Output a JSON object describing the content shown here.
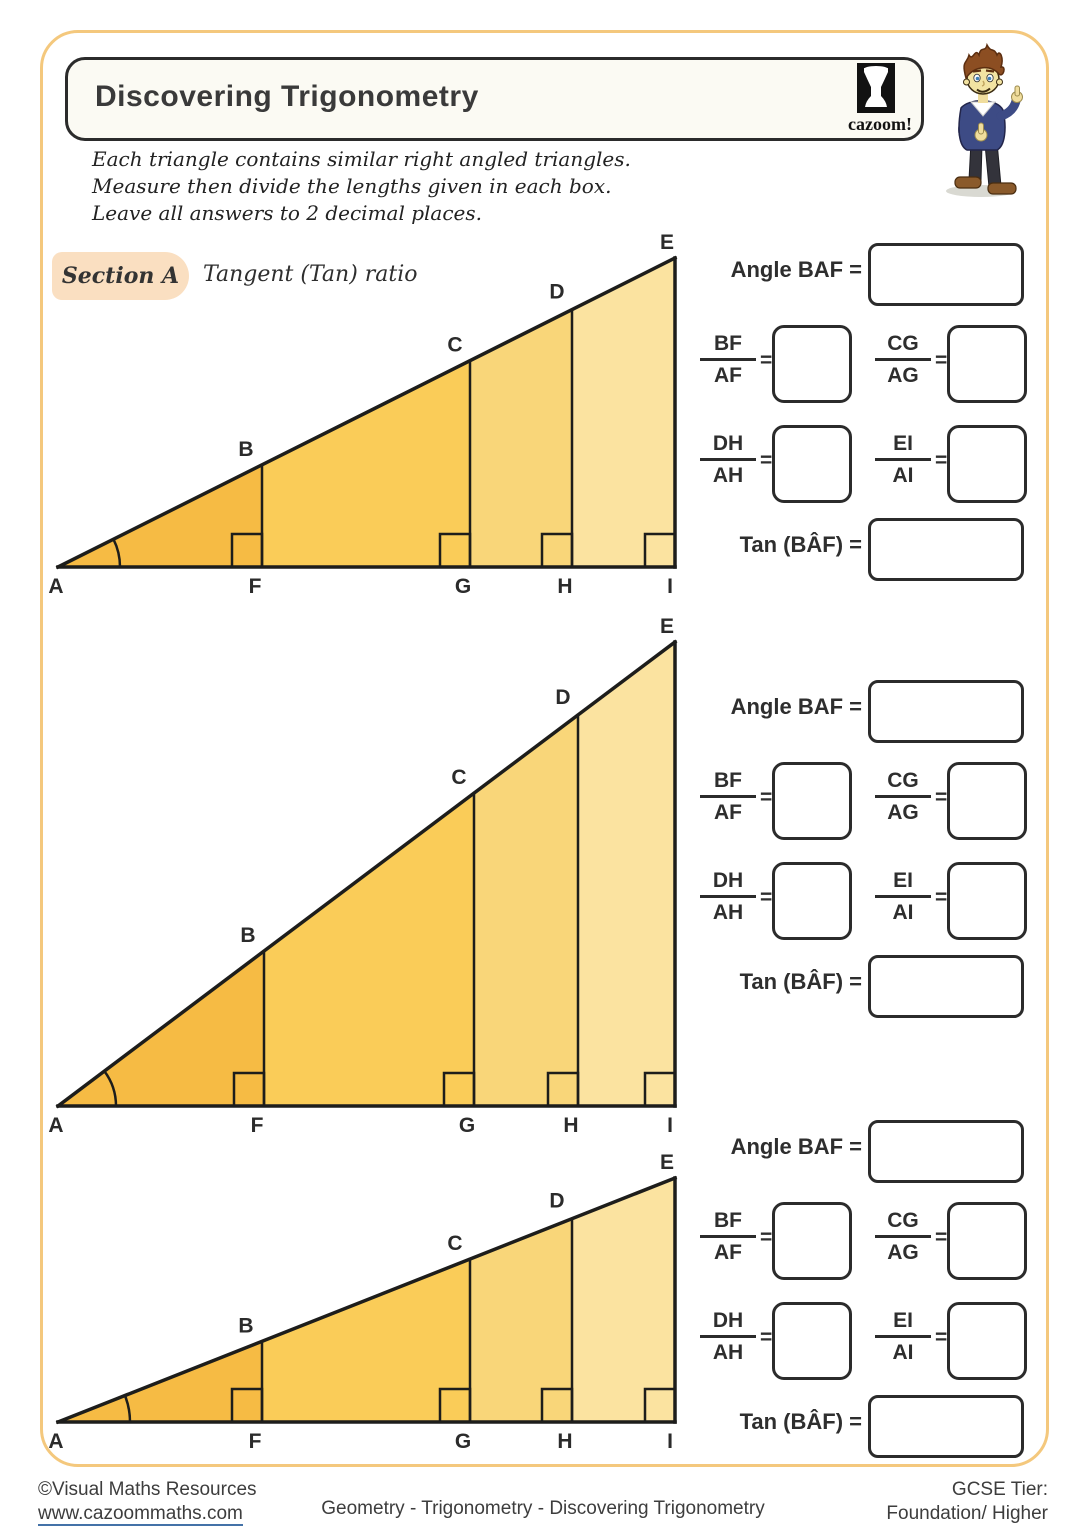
{
  "header": {
    "title": "Discovering Trigonometry",
    "logo_text": "cazoom!"
  },
  "instructions": {
    "line1": "Each triangle contains similar right angled triangles.",
    "line2": "Measure then divide the lengths given in each box.",
    "line3": "Leave all answers to 2 decimal places."
  },
  "section_a": {
    "chip": "Section A",
    "subtitle": "Tangent (Tan) ratio"
  },
  "answer_panel": {
    "angle_label": "Angle BAF =",
    "tan_label": "Tan (BÂF) =",
    "equals": "=",
    "fractions": [
      {
        "num": "BF",
        "den": "AF"
      },
      {
        "num": "CG",
        "den": "AG"
      },
      {
        "num": "DH",
        "den": "AH"
      },
      {
        "num": "EI",
        "den": "AI"
      }
    ],
    "groups": [
      {
        "angle_value": "",
        "ratio_values": [
          "",
          "",
          "",
          ""
        ],
        "tan_value": ""
      },
      {
        "angle_value": "",
        "ratio_values": [
          "",
          "",
          "",
          ""
        ],
        "tan_value": ""
      },
      {
        "angle_value": "",
        "ratio_values": [
          "",
          "",
          "",
          ""
        ],
        "tan_value": ""
      }
    ]
  },
  "diagram": {
    "vertex_labels": {
      "a": "A",
      "b": "B",
      "c": "C",
      "d": "D",
      "e": "E",
      "f": "F",
      "g": "G",
      "h": "H",
      "i": "I"
    },
    "region_fills": [
      "#F6BB44",
      "#FACC58",
      "#F9D679",
      "#FBE3A0"
    ],
    "line_color": "#1D1D1B",
    "label_color": "#2b2b2b",
    "triangles": [
      {
        "a_x": 18,
        "i_x": 635,
        "base_y": 332,
        "apex_y": 23,
        "f_x": 222,
        "g_x": 430,
        "h_x": 532,
        "svg_h": 380,
        "arc_r": 62
      },
      {
        "a_x": 18,
        "i_x": 635,
        "base_y": 496,
        "apex_y": 32,
        "f_x": 224,
        "g_x": 434,
        "h_x": 538,
        "svg_h": 530,
        "arc_r": 58
      },
      {
        "a_x": 18,
        "i_x": 635,
        "base_y": 272,
        "apex_y": 28,
        "f_x": 222,
        "g_x": 430,
        "h_x": 532,
        "svg_h": 300,
        "arc_r": 72
      }
    ]
  },
  "footer": {
    "copyright": "©Visual Maths Resources",
    "website": "www.cazoommaths.com",
    "center": "Geometry - Trigonometry - Discovering Trigonometry",
    "tier_label": "GCSE Tier:",
    "tier_value": "Foundation/ Higher"
  }
}
